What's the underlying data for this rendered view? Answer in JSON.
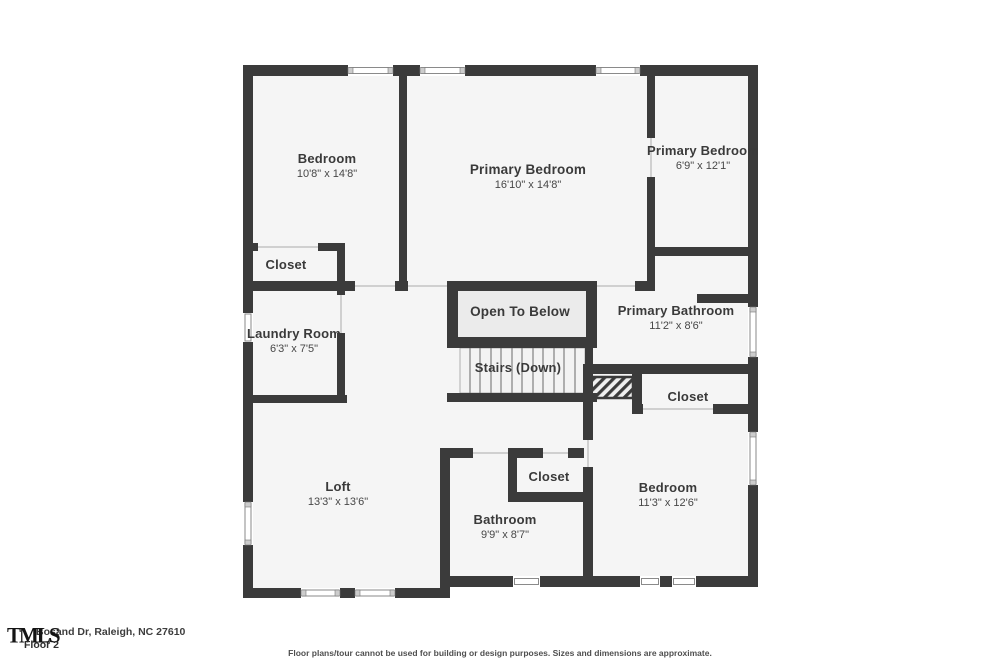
{
  "footer": {
    "logo_text": "TMLS",
    "address": "Bosand Dr, Raleigh, NC 27610",
    "floor_label": "Floor 2",
    "disclaimer": "Floor plans/tour cannot be used for building or design purposes. Sizes and dimensions are approximate."
  },
  "palette": {
    "wall": "#3b3b3b",
    "room_fill": "#f5f5f5",
    "open_to_below_fill": "#ebebeb",
    "window_frame": "#8a8a8a",
    "door_opening": "#c4c4c4",
    "label_text": "#3a3a3a"
  },
  "rooms": [
    {
      "id": "bedroom-1",
      "name": "Bedroom",
      "dims": "10'8\" x 14'8\""
    },
    {
      "id": "primary-bedroom",
      "name": "Primary Bedroom",
      "dims": "16'10\" x 14'8\""
    },
    {
      "id": "primary-bedroom-2",
      "name": "Primary Bedroom",
      "dims": "6'9\" x 12'1\""
    },
    {
      "id": "closet-left",
      "name": "Closet",
      "dims": ""
    },
    {
      "id": "laundry-room",
      "name": "Laundry Room",
      "dims": "6'3\" x 7'5\""
    },
    {
      "id": "open-to-below",
      "name": "Open To Below",
      "dims": ""
    },
    {
      "id": "stairs-down",
      "name": "Stairs (Down)",
      "dims": ""
    },
    {
      "id": "primary-bathroom",
      "name": "Primary Bathroom",
      "dims": "11'2\" x 8'6\""
    },
    {
      "id": "closet-right",
      "name": "Closet",
      "dims": ""
    },
    {
      "id": "loft",
      "name": "Loft",
      "dims": "13'3\" x 13'6\""
    },
    {
      "id": "closet-middle",
      "name": "Closet",
      "dims": ""
    },
    {
      "id": "bathroom",
      "name": "Bathroom",
      "dims": "9'9\" x 8'7\""
    },
    {
      "id": "bedroom-2",
      "name": "Bedroom",
      "dims": "11'3\" x 12'6\""
    }
  ]
}
